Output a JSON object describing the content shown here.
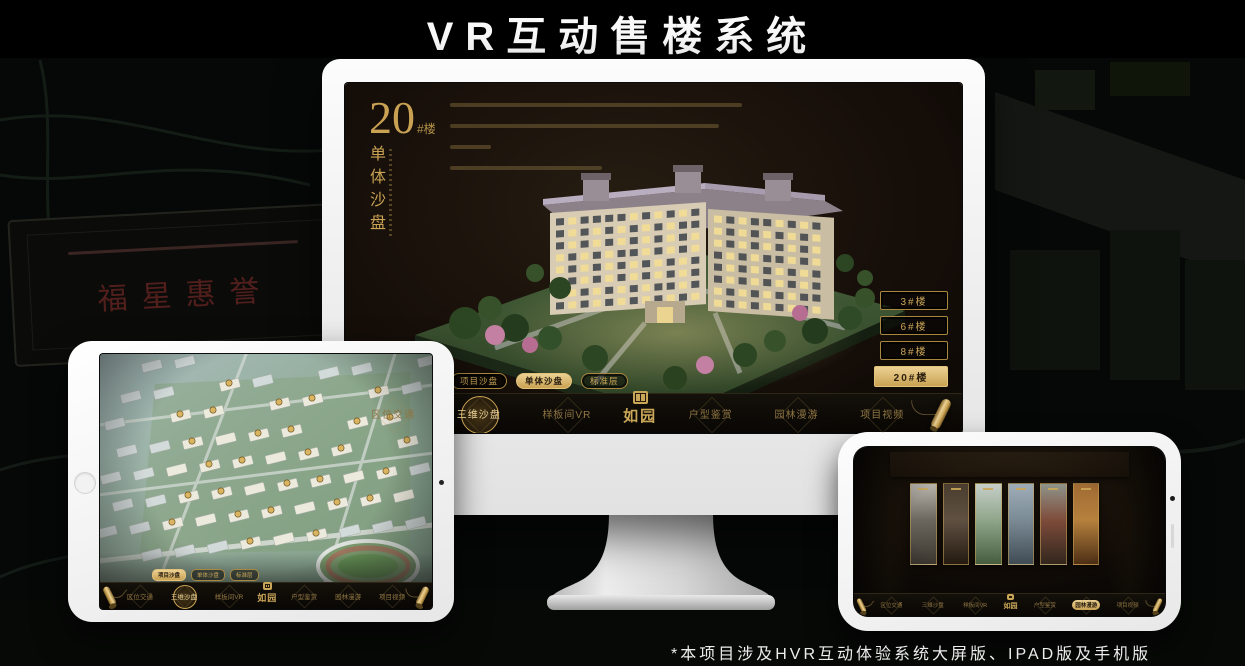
{
  "page": {
    "title": "VR互动售楼系统",
    "footnote": "*本项目涉及HVR互动体验系统大屏版、IPAD版及手机版"
  },
  "colors": {
    "gold": "#c9a253",
    "gold_bright": "#ecd193",
    "screen_bg": "#17110b",
    "navbar_bg": "#0b0906",
    "device_frame": "#f4f4f4"
  },
  "background": {
    "plaque_text": "福星惠誉"
  },
  "brand": {
    "logo_text": "如园",
    "seal_icon": "seal-icon"
  },
  "monitor": {
    "heading": {
      "number": "20",
      "suffix": "#楼",
      "subtitle": "单体沙盘"
    },
    "floor_buttons": [
      {
        "label": "3#楼",
        "active": false
      },
      {
        "label": "6#楼",
        "active": false
      },
      {
        "label": "8#楼",
        "active": false
      },
      {
        "label": "20#楼",
        "active": true
      }
    ],
    "sub_tabs": [
      {
        "label": "项目沙盘",
        "active": false
      },
      {
        "label": "单体沙盘",
        "active": true
      },
      {
        "label": "标准层",
        "active": false
      }
    ],
    "nav_items": [
      {
        "label": "区位交通",
        "active": false
      },
      {
        "label": "三维沙盘",
        "active": true
      },
      {
        "label": "样板间VR",
        "active": false
      },
      {
        "label": "户型鉴赏",
        "active": false
      },
      {
        "label": "园林漫游",
        "active": false
      },
      {
        "label": "项目视频",
        "active": false
      }
    ]
  },
  "ipad": {
    "sub_tabs": [
      {
        "label": "项目沙盘",
        "active": true
      },
      {
        "label": "单体沙盘",
        "active": false
      },
      {
        "label": "标准层",
        "active": false
      }
    ],
    "nav_items": [
      {
        "label": "区位交通",
        "active": false
      },
      {
        "label": "三维沙盘",
        "active": true
      },
      {
        "label": "样板间VR",
        "active": false
      },
      {
        "label": "户型鉴赏",
        "active": false
      },
      {
        "label": "园林漫游",
        "active": false
      },
      {
        "label": "项目视频",
        "active": false
      }
    ]
  },
  "phone": {
    "nav_items": [
      {
        "label": "区位交通",
        "active": false
      },
      {
        "label": "三维沙盘",
        "active": false
      },
      {
        "label": "样板间VR",
        "active": false
      },
      {
        "label": "户型鉴赏",
        "active": false
      },
      {
        "label": "园林漫游",
        "active": true
      },
      {
        "label": "项目视频",
        "active": false
      }
    ]
  }
}
